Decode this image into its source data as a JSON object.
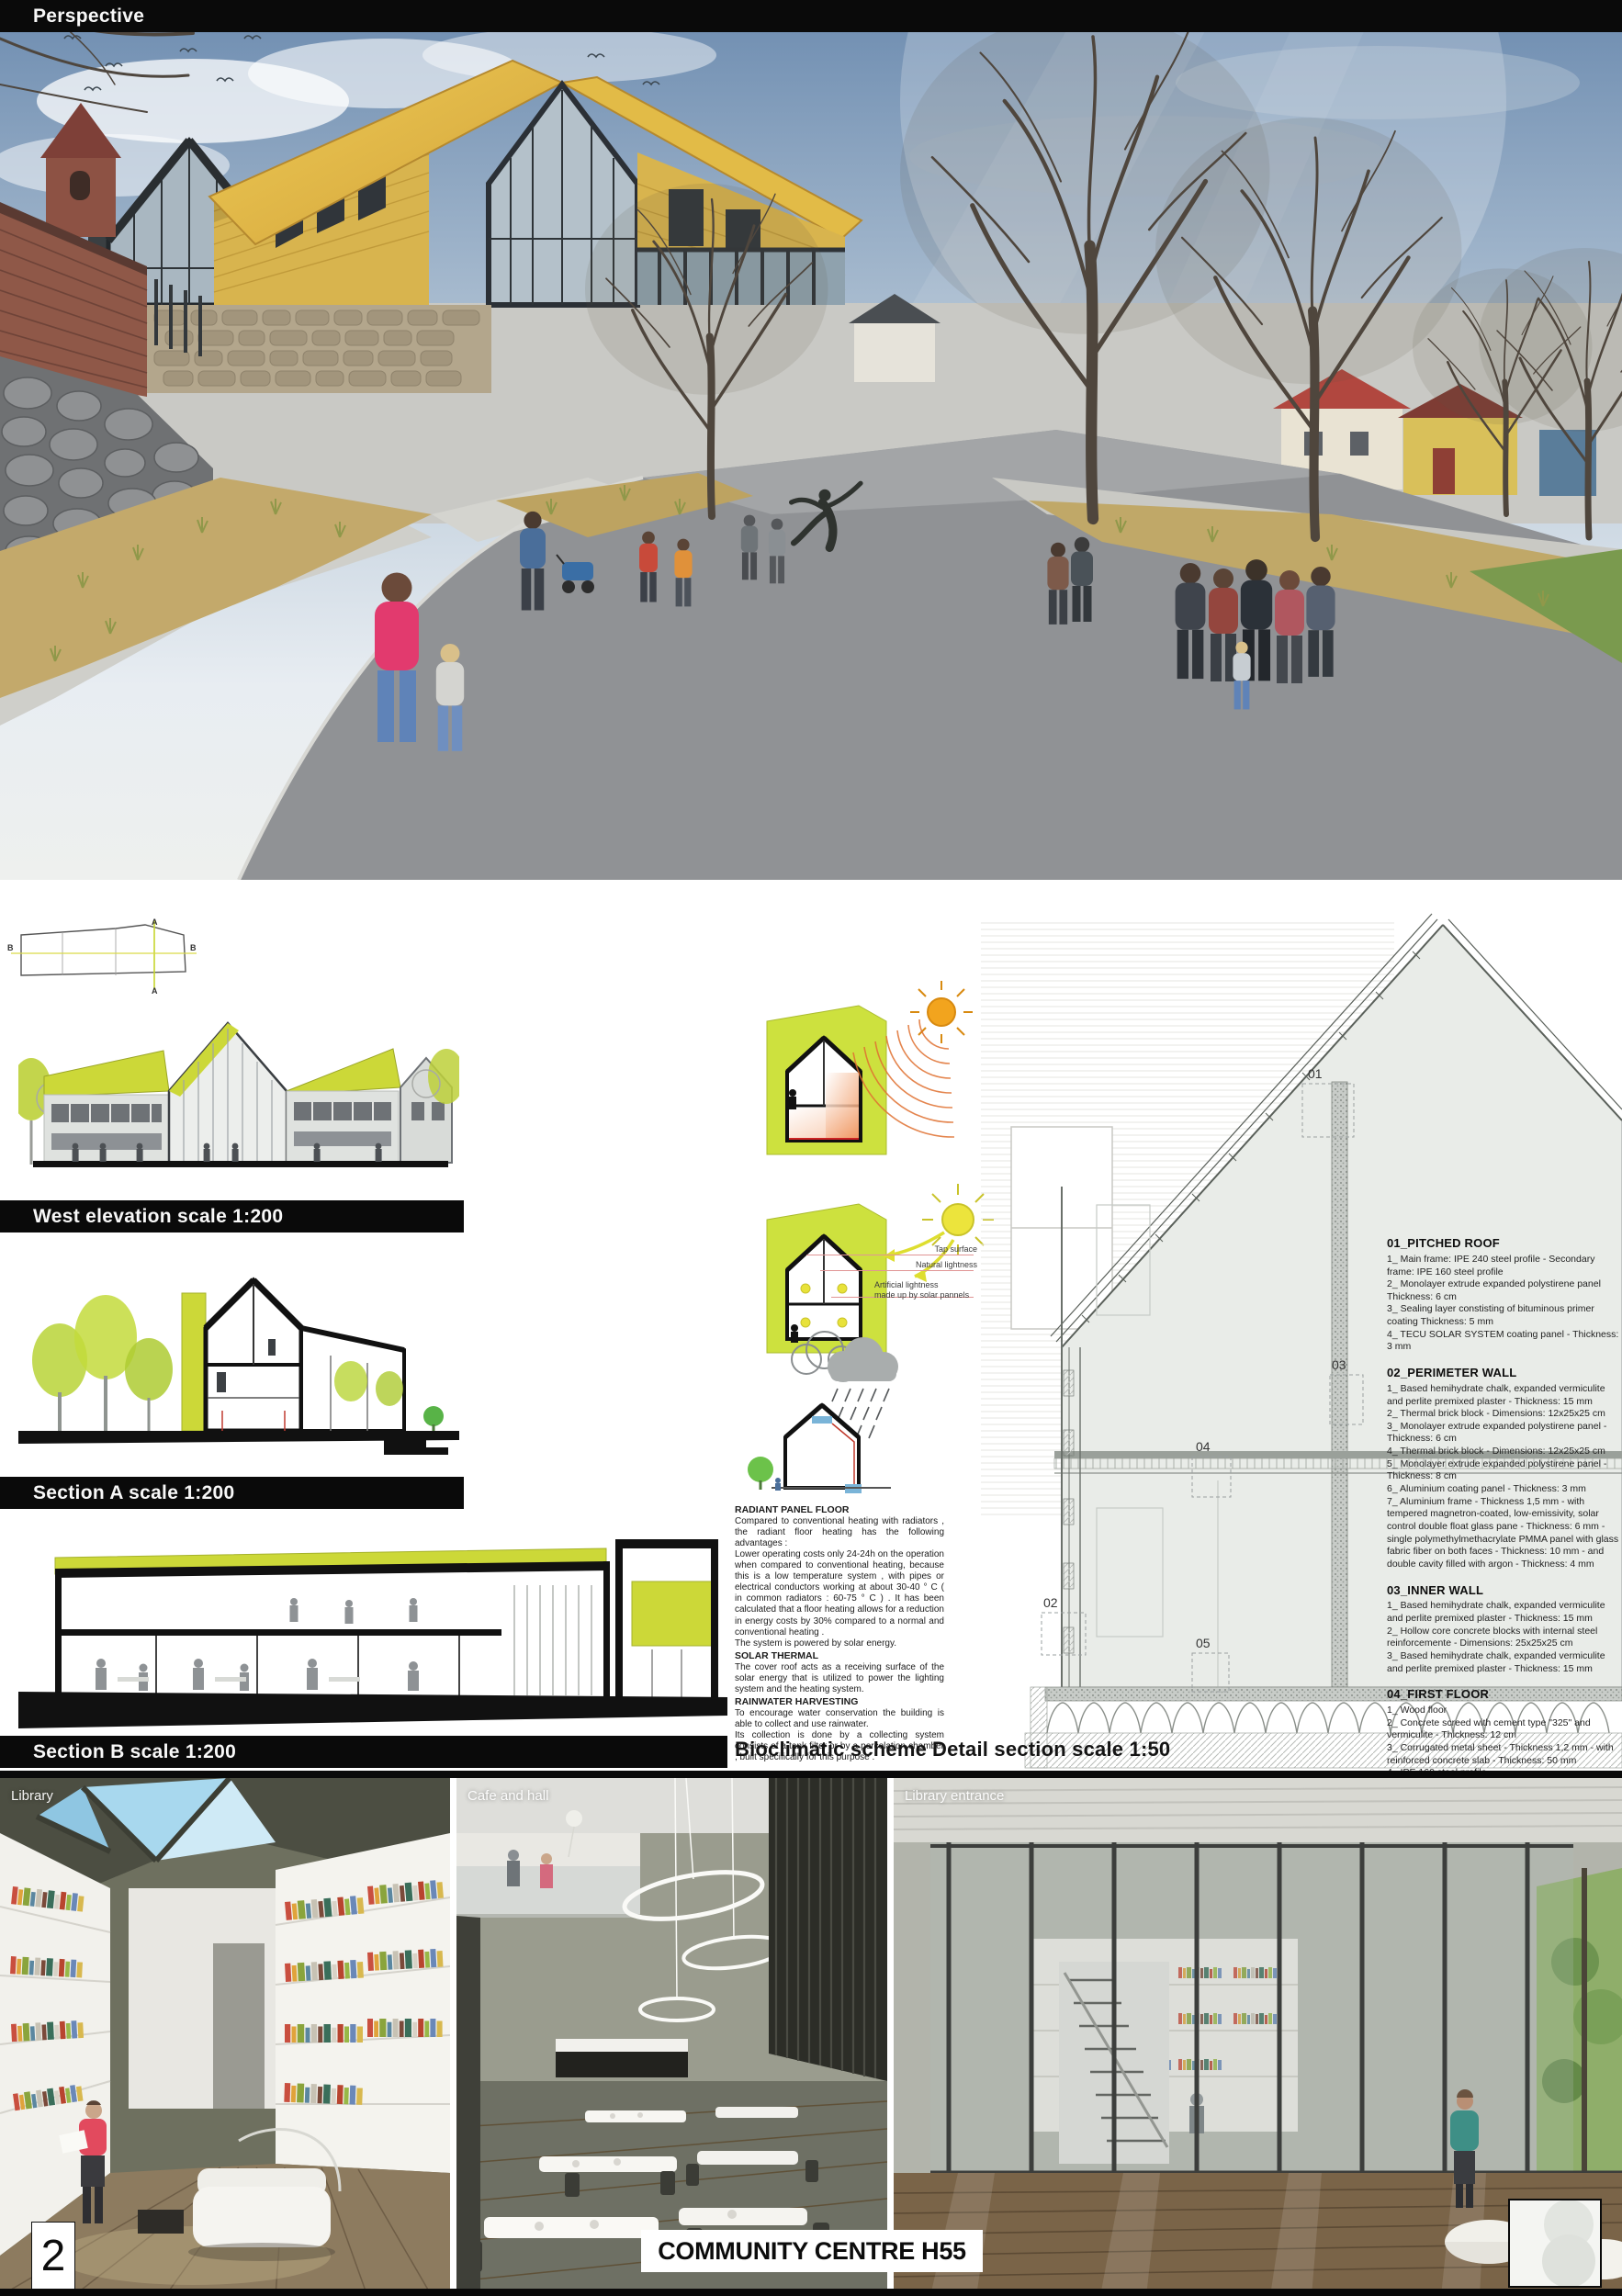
{
  "colors": {
    "accent_lime": "#cbd838",
    "roof_gold": "#e5c04c",
    "bar_black": "#0a0a0a",
    "sun_orange": "#f2a41e",
    "sun_yellow": "#ece43c",
    "heat_orange": "#e87840"
  },
  "perspective": {
    "label": "Perspective"
  },
  "plan": {
    "marker_a": "A",
    "marker_b": "B"
  },
  "elevations": {
    "west_label": "West elevation scale 1:200",
    "section_a_label": "Section A scale 1:200",
    "section_b_label": "Section B scale 1:200"
  },
  "bioclimatic": {
    "title": "Bioclimatic scheme",
    "diagram_labels": {
      "tap": "Tap surface",
      "natural": "Natural lightness",
      "artificial": "Artificial lightness\nmade up by solar pannels"
    },
    "paragraphs": [
      {
        "heading": "RADIANT PANEL FLOOR",
        "body": "Compared to conventional heating  with radiators , the radiant floor heating has the following advantages :\nLower operating costs only 24-24h on the operation when compared to conventional heating, because this is a low temperature system , with pipes or electrical conductors working at about 30-40 ° C ( in common radiators : 60-75 ° C ) . It has been calculated that a floor heating allows for a reduction in energy costs by 30% compared to a normal and conventional heating .\nThe system is powered by solar energy."
      },
      {
        "heading": "SOLAR THERMAL",
        "body": "The cover roof acts as a receiving surface of the solar energy that is utilized to power the lighting system and the heating system."
      },
      {
        "heading": "RAINWATER HARVESTING",
        "body": "To encourage water conservation the building is able to collect and use rainwater.\nIts collection is done by a collecting system consists of a tank filter or by a percolation chamber , built specifically for this purpose ."
      }
    ]
  },
  "detail": {
    "title": "Detail section scale 1:50",
    "callouts": [
      "01",
      "02",
      "03",
      "04",
      "05"
    ],
    "specs": [
      {
        "heading": "01_PITCHED ROOF",
        "items": [
          "1_ Main frame: IPE 240 steel profile - Secondary frame: IPE 160 steel profile",
          "2_ Monolayer extrude expanded polystirene panel Thickness: 6 cm",
          "3_ Sealing layer constisting of bituminous primer coating Thickness: 5 mm",
          "4_ TECU SOLAR SYSTEM coating panel - Thickness: 3 mm"
        ]
      },
      {
        "heading": "02_PERIMETER WALL",
        "items": [
          "1_ Based hemihydrate chalk, expanded vermiculite and perlite premixed plaster - Thickness: 15 mm",
          "2_ Thermal brick block - Dimensions: 12x25x25 cm",
          "3_ Monolayer extrude expanded polystirene panel - Thickness: 6 cm",
          "4_ Thermal brick block - Dimensions: 12x25x25 cm",
          "5_ Monolayer extrude expanded polystirene panel - Thickness: 8 cm",
          "6_ Aluminium coating panel - Thickness: 3 mm",
          "7_ Aluminium frame - Thickness 1,5 mm - with tempered magnetron-coated, low-emissivity, solar control double float glass pane - Thickness: 6 mm -  single polymethylmethacrylate PMMA panel with glass fabric fiber on both faces - Thickness: 10 mm -  and double cavity filled with argon - Thickness: 4 mm"
        ]
      },
      {
        "heading": "03_INNER WALL",
        "items": [
          "1_ Based hemihydrate chalk, expanded vermiculite and perlite premixed plaster - Thickness: 15 mm",
          "2_ Hollow core concrete blocks with internal steel reinforcemente - Dimensions: 25x25x25 cm",
          "3_ Based hemihydrate chalk, expanded vermiculite and perlite premixed plaster - Thickness: 15 mm"
        ]
      },
      {
        "heading": "04_FIRST FLOOR",
        "items": [
          "1_ Wood floor",
          "2_ Concrete screed with cement type \"325\" and vermiculite - Thickness: 12 cm",
          "3_ Corrugated metal sheet - Thickness 1,2 mm - with reinforced concrete slab - Thickness: 50 mm",
          "4_ IPE 160 steel profile",
          "5_ Drywall false ceiling - Dimensions: 60x60x1,2 mm"
        ]
      },
      {
        "heading": "05_GROUND FLOOR",
        "items": [
          "1_ Wood floor",
          "2_ Concrete screed with cement type \"325\" and vermiculite - Thickness: 12 cm",
          "3_ Monolayer extrude expanded polystirene panel - Thickness: 6 cm",
          "4_ Modular plastic formwork, type \"Igloo\" - Height: 55 cm"
        ]
      }
    ]
  },
  "interiors": {
    "panels": [
      {
        "label": "Library"
      },
      {
        "label": "Cafe and hall"
      },
      {
        "label": "Library entrance"
      }
    ]
  },
  "footer": {
    "page_number": "2",
    "board_title": "COMMUNITY CENTRE H55"
  }
}
